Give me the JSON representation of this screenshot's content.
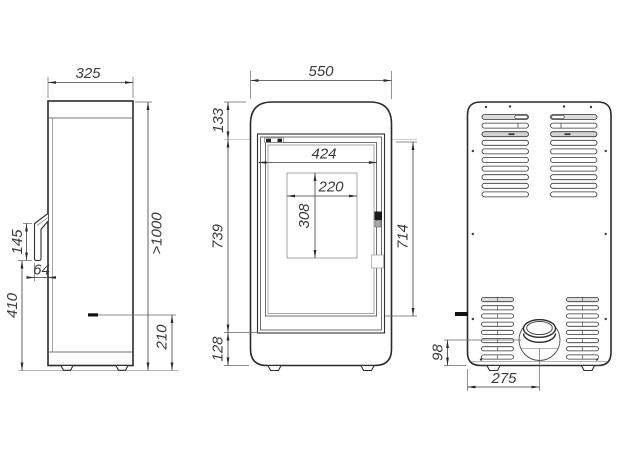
{
  "views": {
    "side": {
      "width": "325",
      "handle_height": "145",
      "handle_depth": "64",
      "handle_clearance": "410",
      "overall_height": ">1000",
      "intake_height": "210"
    },
    "front": {
      "width": "550",
      "top_band": "133",
      "door_height": "739",
      "plinth_height": "128",
      "glass_width": "424",
      "window_width": "220",
      "window_height": "308",
      "door_inner_height": "714"
    },
    "back": {
      "flue_center_height": "98",
      "flue_center_offset": "275"
    }
  }
}
